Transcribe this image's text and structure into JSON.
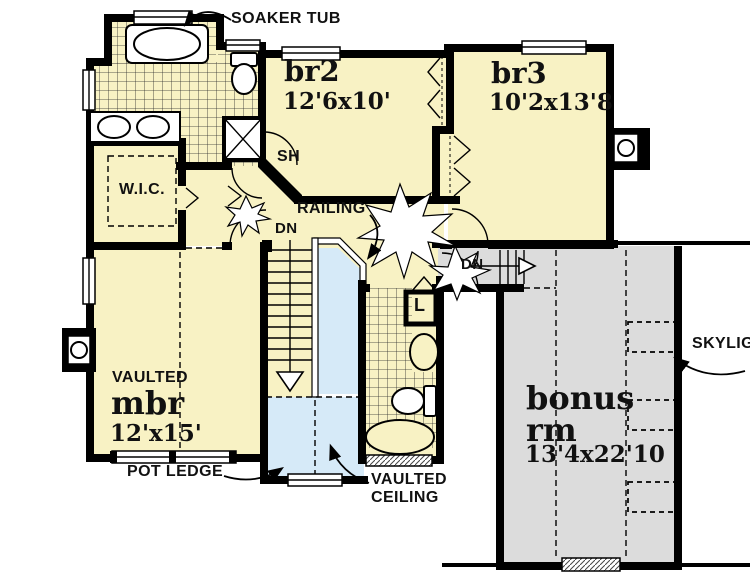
{
  "plan": {
    "colors": {
      "room_fill": "#F8F2C4",
      "open_to_below_fill": "#D6EAF8",
      "bonus_fill": "#DCDCDC",
      "wall": "#000000",
      "background": "#FFFFFF"
    },
    "rooms": {
      "br2": {
        "name": "br2",
        "dims": "12'6x10'"
      },
      "br3": {
        "name": "br3",
        "dims": "10'2x13'8"
      },
      "mbr": {
        "name": "mbr",
        "dims": "12'x15'",
        "ceiling_note": "VAULTED"
      },
      "bonus": {
        "name_line1": "bonus",
        "name_line2": "rm",
        "dims": "13'4x22'10"
      },
      "wic": {
        "name": "W.I.C."
      }
    },
    "annotations": {
      "soaker_tub": "SOAKER TUB",
      "shower": "SH",
      "railing": "RAILING",
      "down_main": "DN",
      "down_bonus": "DN",
      "linen": "L",
      "pot_ledge": "POT LEDGE",
      "vaulted_ceiling_line1": "VAULTED",
      "vaulted_ceiling_line2": "CEILING",
      "skylight": "SKYLIG"
    }
  }
}
